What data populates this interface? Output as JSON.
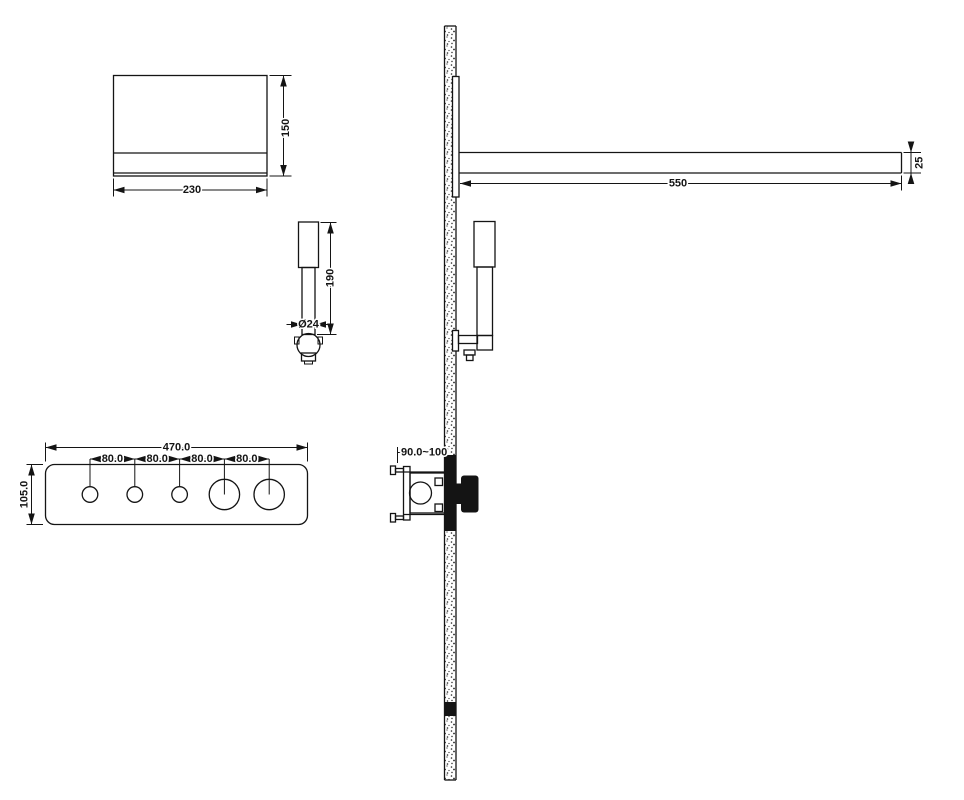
{
  "diagram": {
    "background_color": "#ffffff",
    "line_color": "#141414",
    "knob_fill_color": "#141414",
    "views": {
      "shower_head_top": {
        "width_label": "230",
        "height_label": "150"
      },
      "hand_shower_front": {
        "length_label": "190",
        "diameter_label": "Ø24"
      },
      "control_panel": {
        "width_label": "470.0",
        "height_label": "105.0",
        "spacing_labels": [
          "80.0",
          "80.0",
          "80.0",
          "80.0"
        ]
      },
      "wall_side_view": {
        "arm_length_label": "550",
        "arm_height_label": "25",
        "valve_depth_label": "90.0~100"
      }
    }
  }
}
